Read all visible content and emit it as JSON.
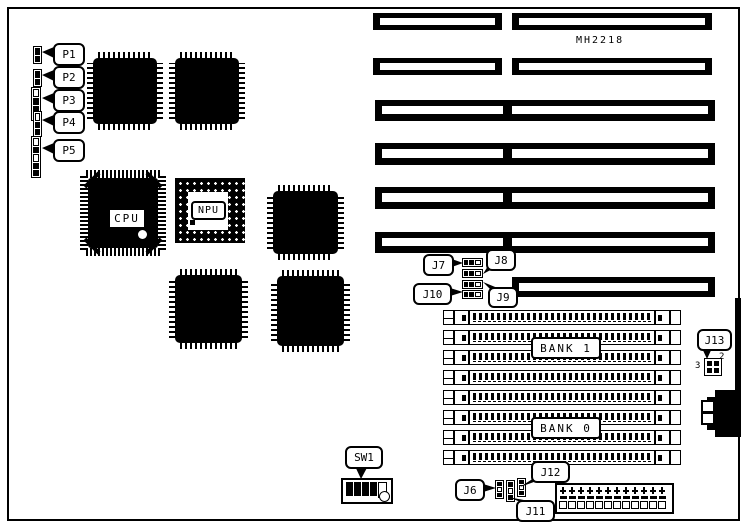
{
  "board_label": "MH2218",
  "chips": {
    "cpu": "CPU",
    "npu": "NPU"
  },
  "banks": {
    "bank1": "BANK 1",
    "bank0": "BANK 0"
  },
  "connectors": {
    "p1": "P1",
    "p2": "P2",
    "p3": "P3",
    "p4": "P4",
    "p5": "P5"
  },
  "jumpers": {
    "j6": "J6",
    "j7": "J7",
    "j8": "J8",
    "j9": "J9",
    "j10": "J10",
    "j11": "J11",
    "j12": "J12",
    "j13": "J13"
  },
  "switches": {
    "sw1": "SW1"
  },
  "pin_numbers": {
    "j13_pin2": "2",
    "j13_pin3": "3"
  }
}
